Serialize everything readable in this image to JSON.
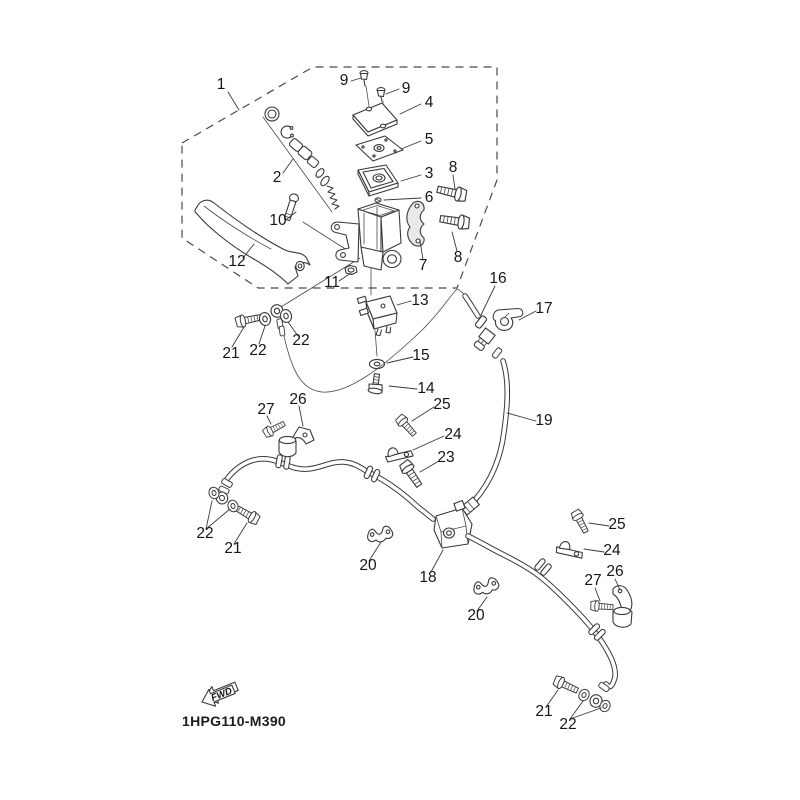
{
  "diagram": {
    "code": "1HPG110-M390",
    "fwd_label": "FWD",
    "background_color": "#ffffff",
    "line_color": "#3a3a3a"
  },
  "callouts": [
    {
      "label": "1"
    },
    {
      "label": "9"
    },
    {
      "label": "9"
    },
    {
      "label": "4"
    },
    {
      "label": "5"
    },
    {
      "label": "3"
    },
    {
      "label": "8"
    },
    {
      "label": "6"
    },
    {
      "label": "2"
    },
    {
      "label": "10"
    },
    {
      "label": "12"
    },
    {
      "label": "7"
    },
    {
      "label": "8"
    },
    {
      "label": "11"
    },
    {
      "label": "13"
    },
    {
      "label": "16"
    },
    {
      "label": "17"
    },
    {
      "label": "21"
    },
    {
      "label": "22"
    },
    {
      "label": "22"
    },
    {
      "label": "15"
    },
    {
      "label": "14"
    },
    {
      "label": "19"
    },
    {
      "label": "26"
    },
    {
      "label": "27"
    },
    {
      "label": "25"
    },
    {
      "label": "24"
    },
    {
      "label": "23"
    },
    {
      "label": "22"
    },
    {
      "label": "21"
    },
    {
      "label": "20"
    },
    {
      "label": "18"
    },
    {
      "label": "20"
    },
    {
      "label": "25"
    },
    {
      "label": "24"
    },
    {
      "label": "26"
    },
    {
      "label": "27"
    },
    {
      "label": "21"
    },
    {
      "label": "22"
    }
  ]
}
